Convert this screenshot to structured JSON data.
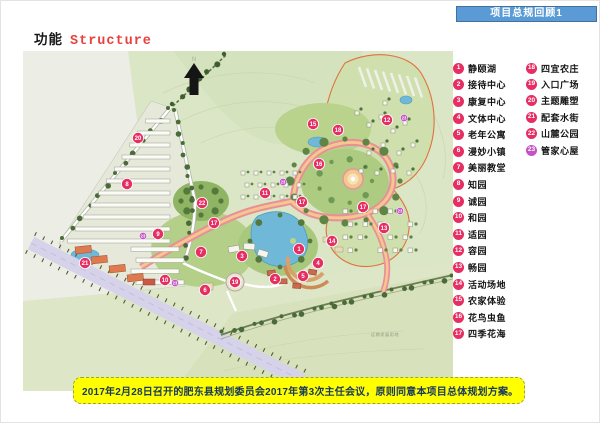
{
  "banner": {
    "title": "项目总规回顾1"
  },
  "title": {
    "zh": "功能",
    "en": "Structure"
  },
  "note": {
    "text": "2017年2月28日召开的肥东县规划委员会2017年第3次主任会议，原则同意本项目总体规划方案。"
  },
  "colors": {
    "banner_blue": "#5b9bd5",
    "title_red": "#e8413c",
    "marker_pink": "#e62e63",
    "marker_magenta": "#c653c6",
    "note_yellow": "#ffff00",
    "note_text_navy": "#17375e"
  },
  "legend": {
    "col1": [
      {
        "num": "1",
        "label": "静颐湖"
      },
      {
        "num": "2",
        "label": "接待中心"
      },
      {
        "num": "3",
        "label": "康复中心"
      },
      {
        "num": "4",
        "label": "文体中心"
      },
      {
        "num": "5",
        "label": "老年公寓"
      },
      {
        "num": "6",
        "label": "漫妙小镇"
      },
      {
        "num": "7",
        "label": "美丽教堂"
      },
      {
        "num": "8",
        "label": "知园"
      },
      {
        "num": "9",
        "label": "诚园"
      },
      {
        "num": "10",
        "label": "和园"
      },
      {
        "num": "11",
        "label": "适园"
      },
      {
        "num": "12",
        "label": "容园"
      },
      {
        "num": "13",
        "label": "畅园"
      },
      {
        "num": "14",
        "label": "活动场地"
      },
      {
        "num": "15",
        "label": "农家体验"
      },
      {
        "num": "16",
        "label": "花鸟虫鱼"
      },
      {
        "num": "17",
        "label": "四季花海"
      }
    ],
    "col2": [
      {
        "num": "18",
        "label": "四宜农庄"
      },
      {
        "num": "19",
        "label": "入口广场"
      },
      {
        "num": "20",
        "label": "主题雕塑"
      },
      {
        "num": "21",
        "label": "配套水街"
      },
      {
        "num": "22",
        "label": "山麓公园"
      },
      {
        "num": "23",
        "label": "管家心屋",
        "color": "#c653c6"
      }
    ]
  },
  "map": {
    "north_label": "N",
    "future_land_label": "远期发展用地",
    "markers": [
      {
        "n": "1",
        "x": 276,
        "y": 198
      },
      {
        "n": "2",
        "x": 252,
        "y": 228
      },
      {
        "n": "3",
        "x": 219,
        "y": 205
      },
      {
        "n": "4",
        "x": 295,
        "y": 212
      },
      {
        "n": "5",
        "x": 280,
        "y": 225
      },
      {
        "n": "6",
        "x": 182,
        "y": 239
      },
      {
        "n": "7",
        "x": 178,
        "y": 201
      },
      {
        "n": "8",
        "x": 104,
        "y": 133
      },
      {
        "n": "9",
        "x": 135,
        "y": 183
      },
      {
        "n": "10",
        "x": 142,
        "y": 229
      },
      {
        "n": "11",
        "x": 242,
        "y": 142
      },
      {
        "n": "12",
        "x": 364,
        "y": 69
      },
      {
        "n": "13",
        "x": 361,
        "y": 177
      },
      {
        "n": "14",
        "x": 309,
        "y": 190
      },
      {
        "n": "15",
        "x": 290,
        "y": 73
      },
      {
        "n": "16",
        "x": 296,
        "y": 113
      },
      {
        "n": "17",
        "x": 191,
        "y": 172
      },
      {
        "n": "17",
        "x": 279,
        "y": 151
      },
      {
        "n": "17",
        "x": 340,
        "y": 156
      },
      {
        "n": "18",
        "x": 315,
        "y": 79
      },
      {
        "n": "19",
        "x": 212,
        "y": 231
      },
      {
        "n": "20",
        "x": 115,
        "y": 87
      },
      {
        "n": "21",
        "x": 62,
        "y": 212
      },
      {
        "n": "22",
        "x": 179,
        "y": 152
      },
      {
        "n": "23",
        "x": 381,
        "y": 67,
        "small": true
      },
      {
        "n": "23",
        "x": 260,
        "y": 131,
        "small": true
      },
      {
        "n": "23",
        "x": 152,
        "y": 232,
        "small": true
      },
      {
        "n": "23",
        "x": 377,
        "y": 160,
        "small": true
      },
      {
        "n": "23",
        "x": 120,
        "y": 185,
        "small": true
      }
    ]
  }
}
